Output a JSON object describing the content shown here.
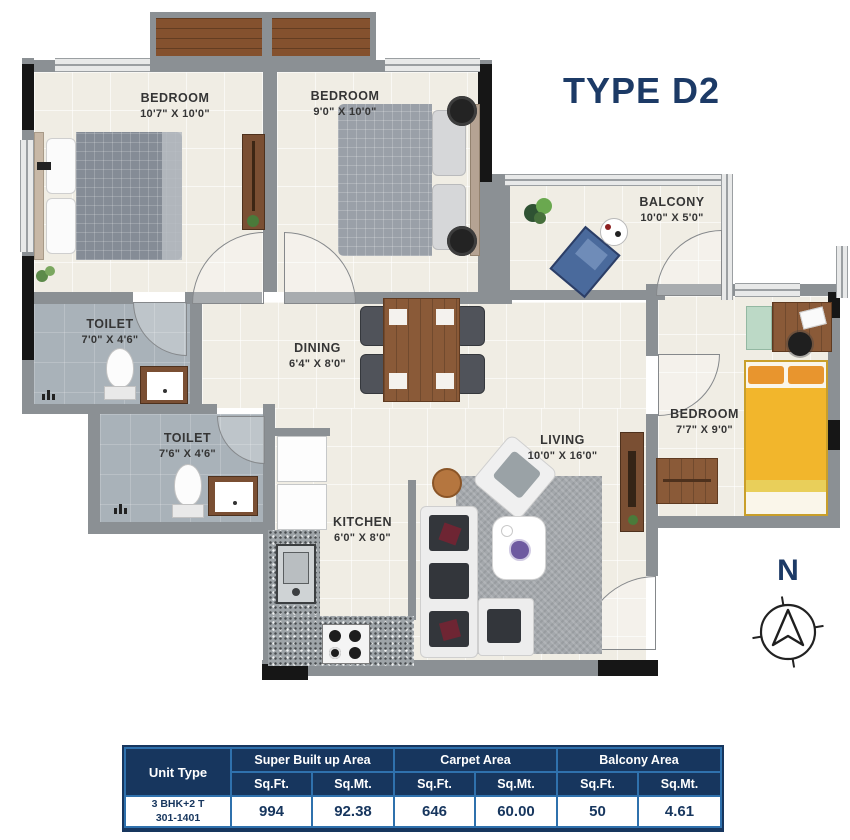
{
  "title": "TYPE D2",
  "compass": {
    "north": "N"
  },
  "rooms": {
    "bedroom1": {
      "name": "BEDROOM",
      "dims": "10'7\" X 10'0\""
    },
    "bedroom2": {
      "name": "BEDROOM",
      "dims": "9'0\" X 10'0\""
    },
    "balcony": {
      "name": "BALCONY",
      "dims": "10'0\" X 5'0\""
    },
    "toilet1": {
      "name": "TOILET",
      "dims": "7'0\" X 4'6\""
    },
    "toilet2": {
      "name": "TOILET",
      "dims": "7'6\" X 4'6\""
    },
    "dining": {
      "name": "DINING",
      "dims": "6'4\" X 8'0\""
    },
    "kitchen": {
      "name": "KITCHEN",
      "dims": "6'0\" X 8'0\""
    },
    "living": {
      "name": "LIVING",
      "dims": "10'0\" X 16'0\""
    },
    "bedroom3": {
      "name": "BEDROOM",
      "dims": "7'7\" X 9'0\""
    }
  },
  "area_table": {
    "header": {
      "unit_type": "Unit Type",
      "groups": [
        "Super Built up Area",
        "Carpet Area",
        "Balcony Area"
      ],
      "sub": [
        "Sq.Ft.",
        "Sq.Mt.",
        "Sq.Ft.",
        "Sq.Mt.",
        "Sq.Ft.",
        "Sq.Mt."
      ]
    },
    "row": {
      "unit_line1": "3 BHK+2 T",
      "unit_line2": "301-1401",
      "values": [
        "994",
        "92.38",
        "646",
        "60.00",
        "50",
        "4.61"
      ]
    }
  },
  "colors": {
    "accent_navy": "#17365e",
    "table_border_blue": "#2f71ad",
    "wall_gray": "#8b9094",
    "floor_cream": "#f0ede4",
    "toilet_floor": "#a9b2b9",
    "wood_brown": "#8a5a38",
    "bed_yellow": "#f2b62c",
    "pillow_orange": "#e8952e",
    "balcony_chair_blue": "#4a6a9c"
  }
}
